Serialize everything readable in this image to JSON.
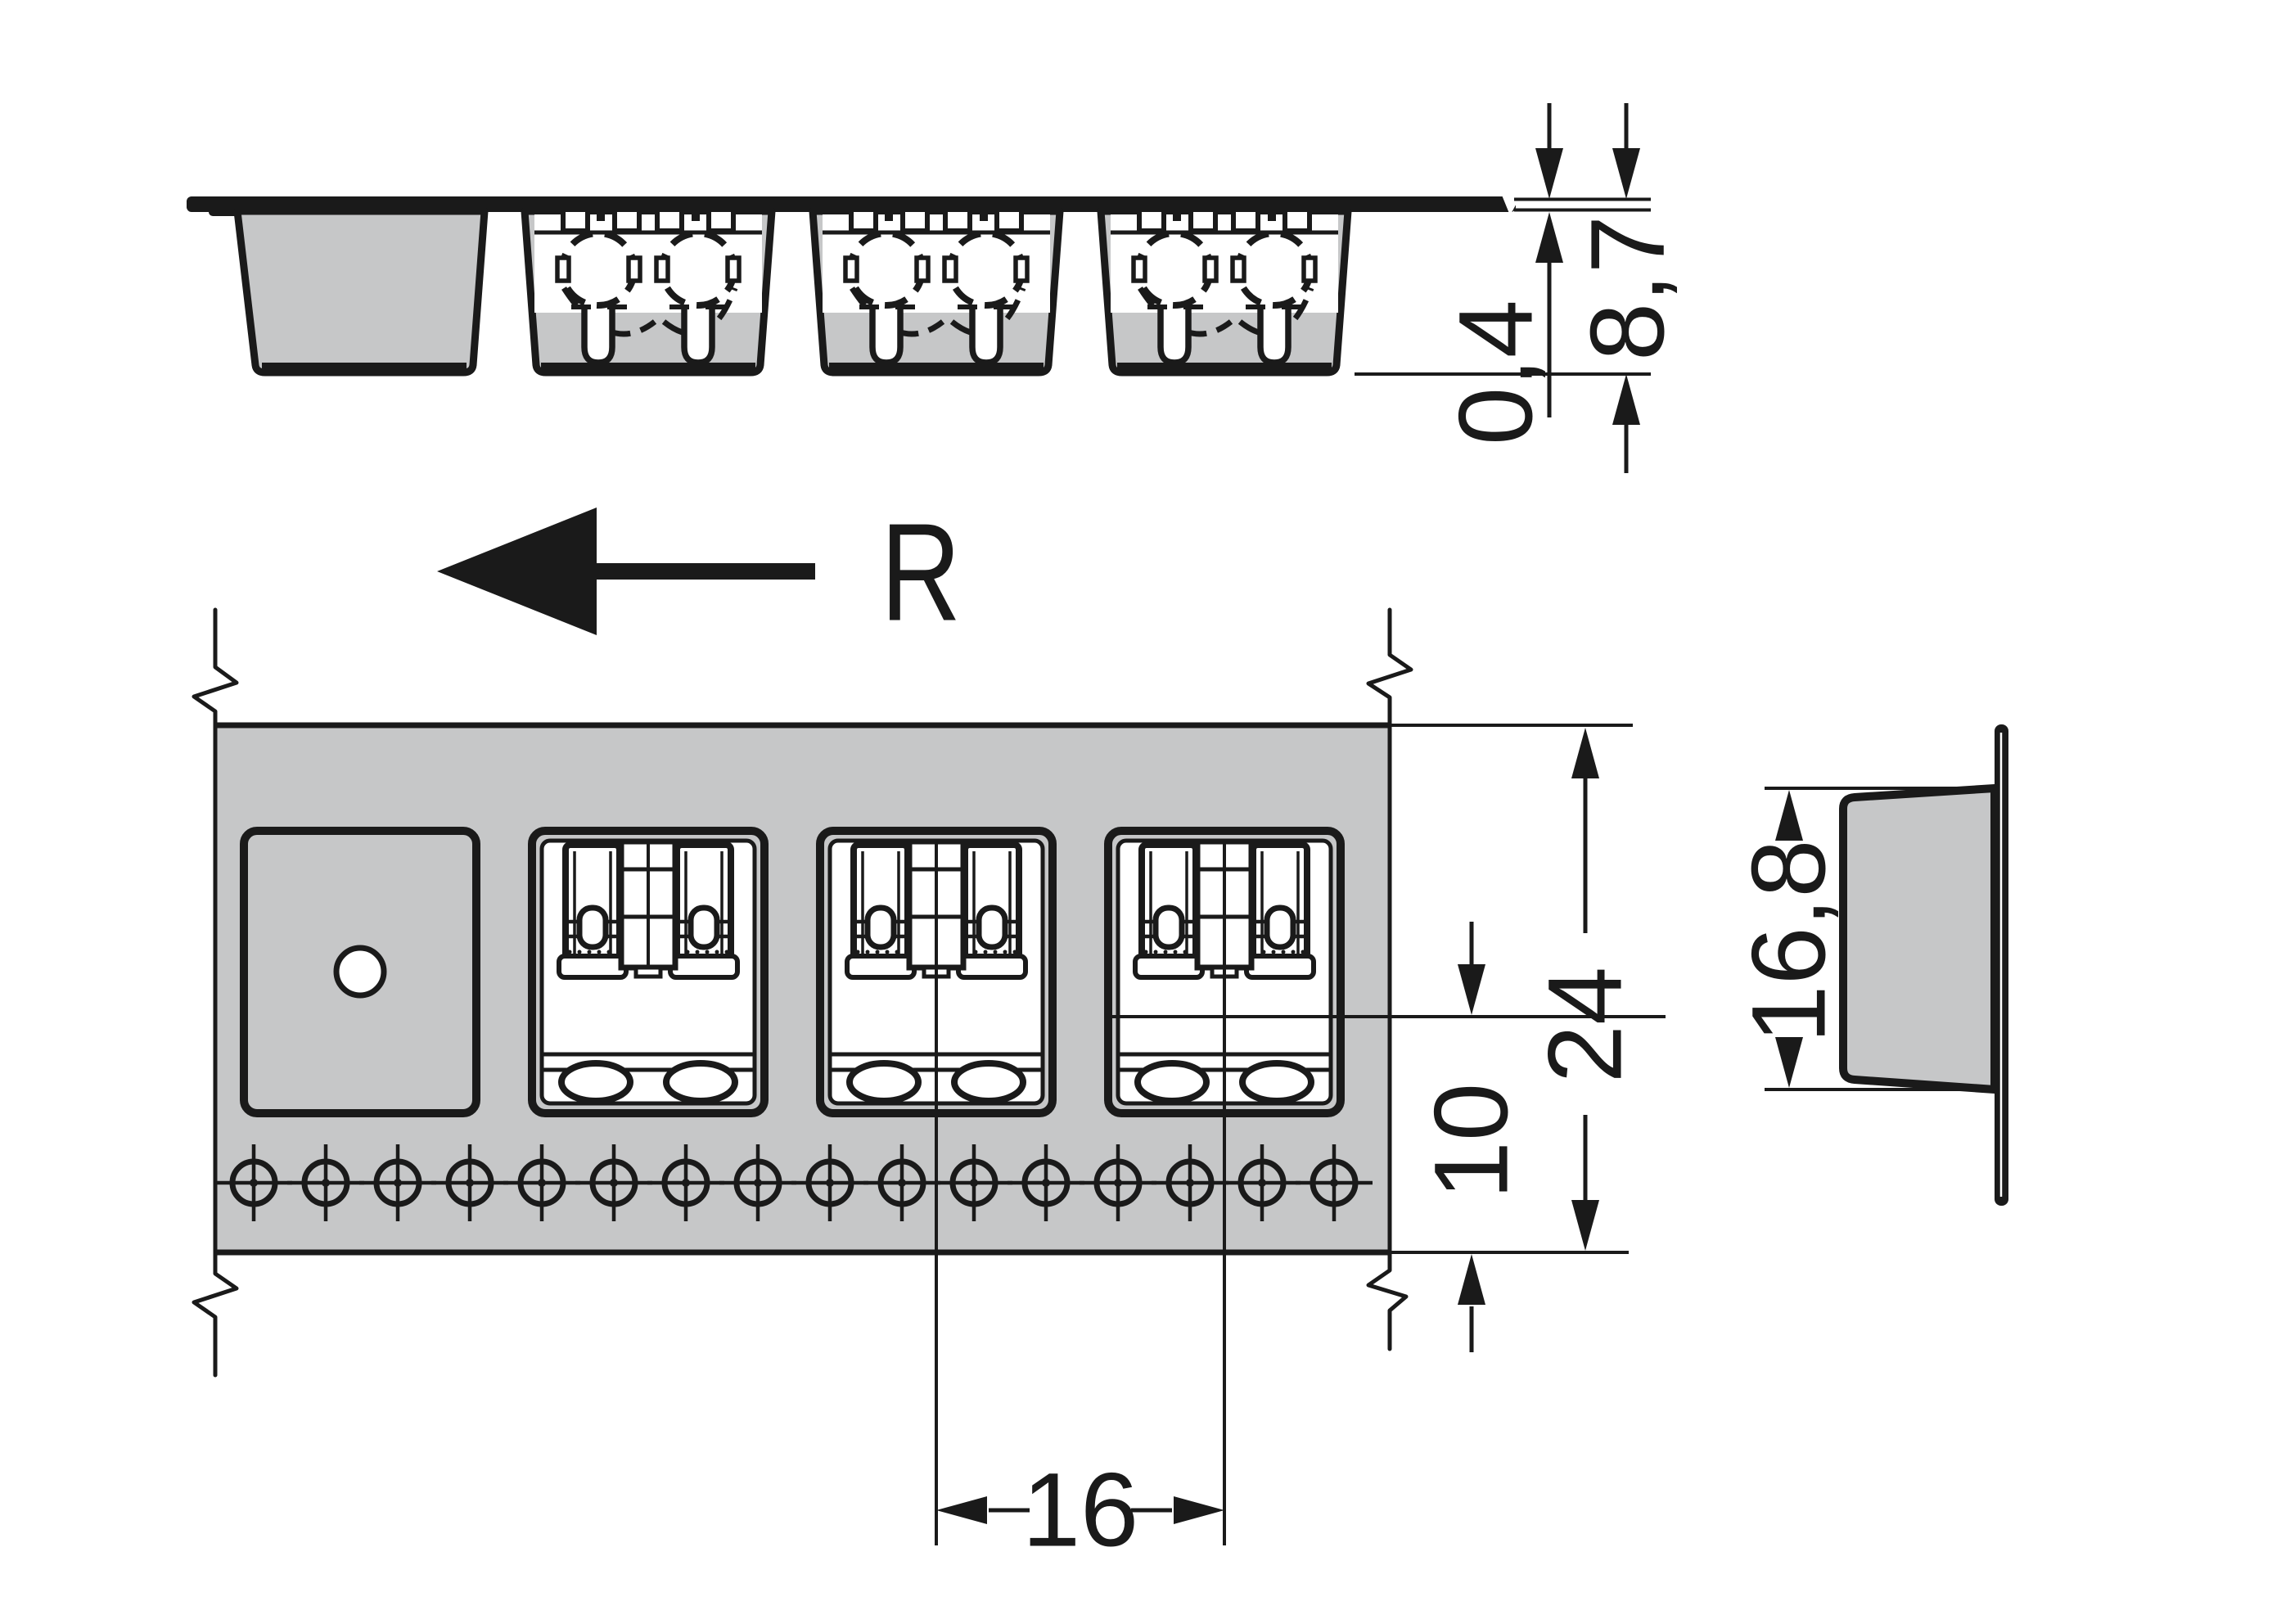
{
  "drawing": {
    "direction_label": "R",
    "dimensions": {
      "tape_thickness": "0,4",
      "pocket_depth": "8,7",
      "tape_width": "24",
      "center_to_edge": "10",
      "pocket_pitch": "16",
      "pocket_height": "16,8"
    },
    "colors": {
      "fill_gray": "#c6c7c8",
      "line_black": "#1a1a1a",
      "background": "#ffffff"
    }
  }
}
